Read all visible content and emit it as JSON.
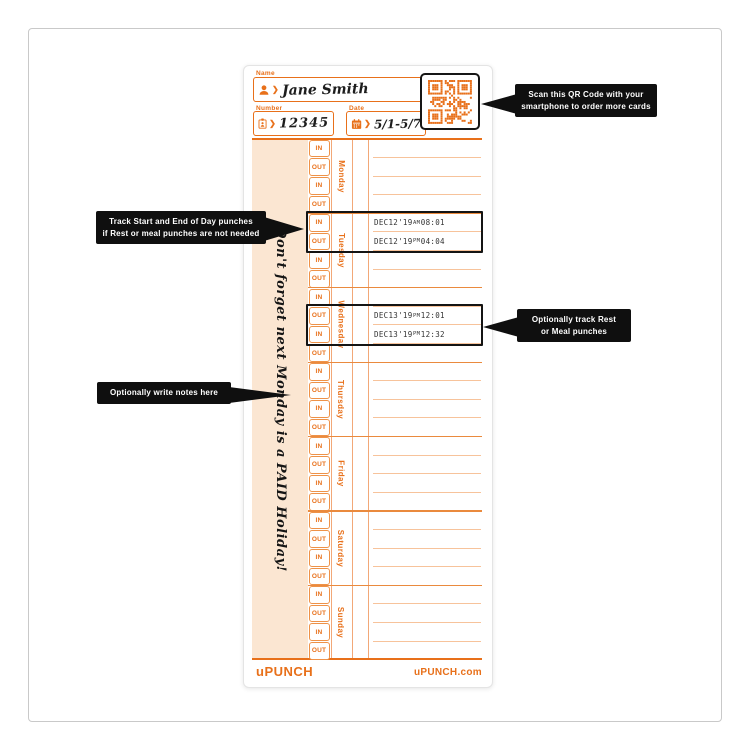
{
  "card": {
    "header": {
      "name_label": "Name",
      "name_value": "Jane Smith",
      "number_label": "Number",
      "number_value": "12345",
      "date_label": "Date",
      "date_value": "5/1-5/7"
    },
    "days": [
      "Monday",
      "Tuesday",
      "Wednesday",
      "Thursday",
      "Friday",
      "Saturday",
      "Sunday"
    ],
    "punch_row_labels": [
      "IN",
      "OUT",
      "IN",
      "OUT"
    ],
    "notes_text": "Don't forget next Monday is a PAID Holiday!",
    "punches": [
      {
        "day": "Tuesday",
        "row_index": 0,
        "row_label": "IN",
        "date": "DEC12'19",
        "ampm": "AM",
        "time": "08:01"
      },
      {
        "day": "Tuesday",
        "row_index": 1,
        "row_label": "OUT",
        "date": "DEC12'19",
        "ampm": "PM",
        "time": "04:04"
      },
      {
        "day": "Wednesday",
        "row_index": 1,
        "row_label": "OUT",
        "date": "DEC13'19",
        "ampm": "PM",
        "time": "12:01"
      },
      {
        "day": "Wednesday",
        "row_index": 2,
        "row_label": "IN",
        "date": "DEC13'19",
        "ampm": "PM",
        "time": "12:32"
      }
    ],
    "footer": {
      "brand": "uPUNCH",
      "website": "uPUNCH.com"
    }
  },
  "callouts": {
    "qr": {
      "lines": [
        "Scan this QR Code with your",
        "smartphone to order more cards"
      ]
    },
    "track": {
      "lines": [
        "Track Start and End of Day punches",
        "if Rest or meal punches are not needed"
      ]
    },
    "rest": {
      "lines": [
        "Optionally track Rest",
        "or Meal punches"
      ]
    },
    "notes": {
      "lines": [
        "Optionally write notes here"
      ]
    }
  },
  "colors": {
    "orange": "#e8701a",
    "peach": "#fbe6d2",
    "callout_bg": "#0f0f0f",
    "highlight_border": "#141414"
  }
}
